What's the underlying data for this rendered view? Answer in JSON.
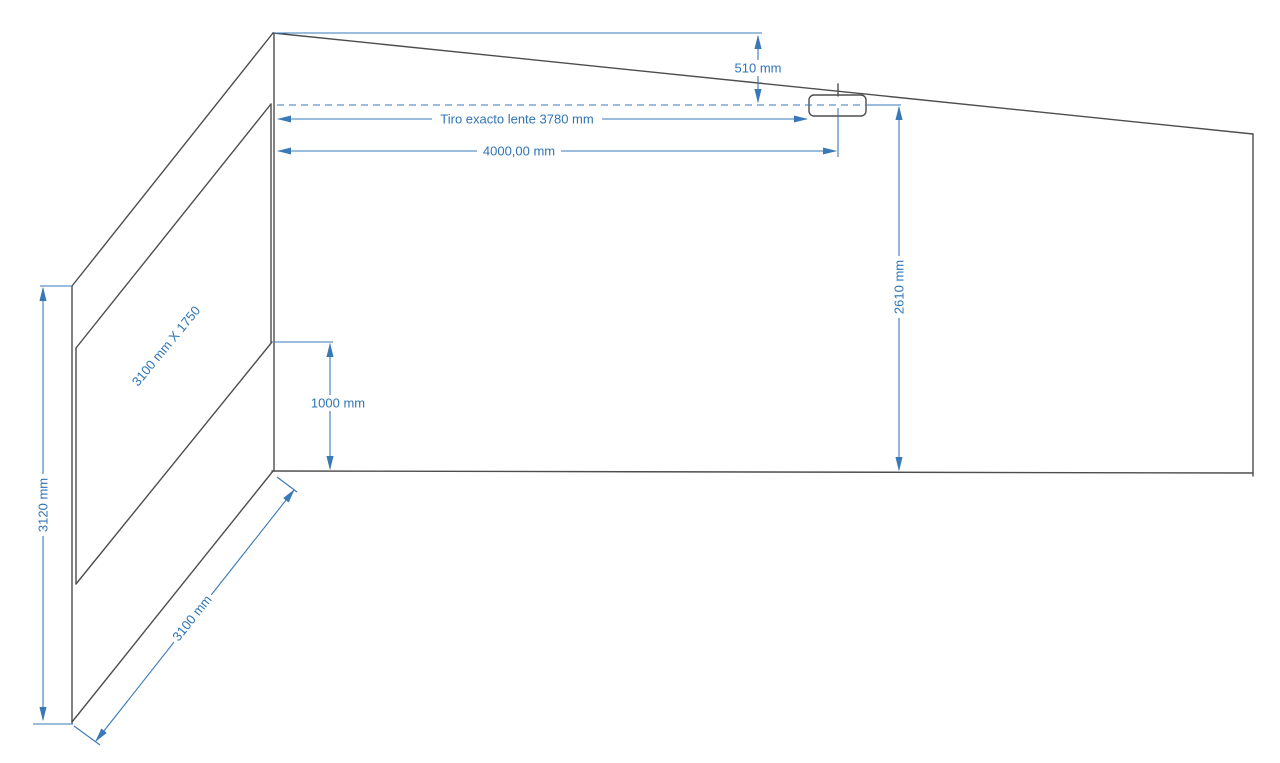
{
  "page": {
    "background": "#ffffff",
    "description": "CAD elevation drawing of a projection room with screen wall and ceiling-mounted projector"
  },
  "colors": {
    "page-bg": "#ffffff",
    "model-line": "#4d4d4d",
    "dim-line": "#3a79b8",
    "dim-text": "#2e74b5"
  },
  "drawing": {
    "labels": {
      "ceiling_drop": "510 mm",
      "lens_throw": "Tiro exacto lente 3780 mm",
      "projector_distance": "4000,00 mm",
      "lens_height": "2610 mm",
      "screen_size": "3100 mm X 1750",
      "screen_bottom_height": "1000 mm",
      "wall_height": "3120 mm",
      "wall_width": "3100 mm"
    }
  }
}
